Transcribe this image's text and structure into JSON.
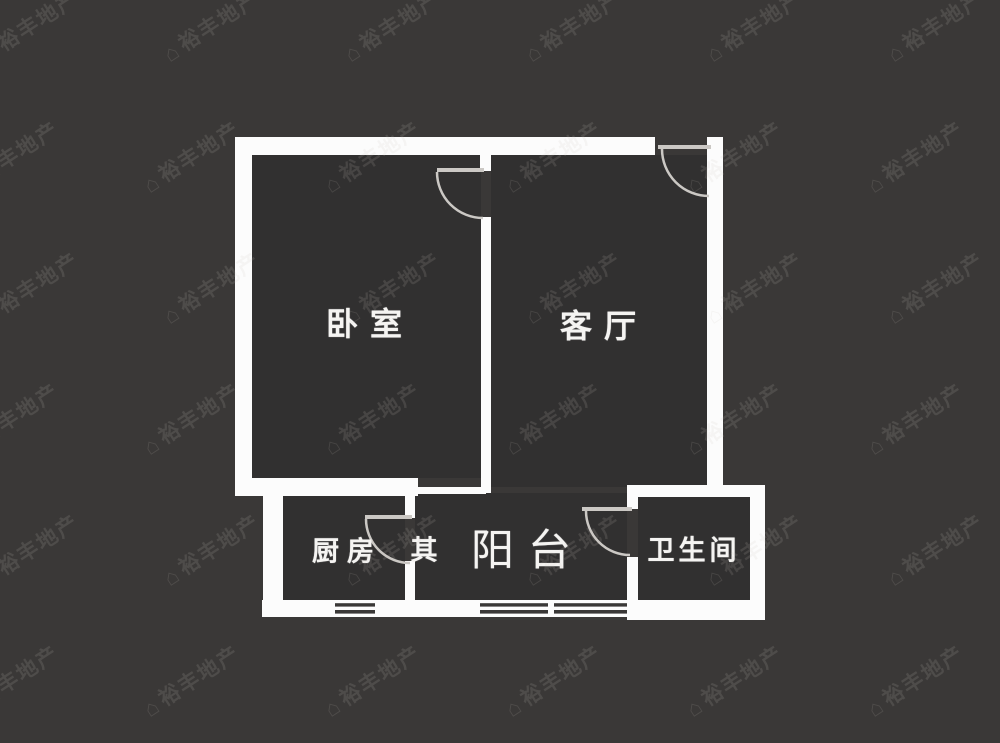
{
  "floor_plan": {
    "background_color": "#3a3837",
    "room_fill_color": "#313030",
    "wall_color": "#fcfcfc",
    "door_color": "#cbc8c4",
    "rooms": [
      {
        "id": "bedroom",
        "label": "卧室"
      },
      {
        "id": "living-room",
        "label": "客厅"
      },
      {
        "id": "kitchen",
        "label": "厨房"
      },
      {
        "id": "other",
        "label": "其"
      },
      {
        "id": "balcony",
        "label": "阳台"
      },
      {
        "id": "bathroom",
        "label": "卫生间"
      }
    ]
  },
  "watermark": {
    "icon": "house-logo-icon",
    "text": "裕丰地产",
    "color": "rgba(205,200,190,0.14)"
  }
}
